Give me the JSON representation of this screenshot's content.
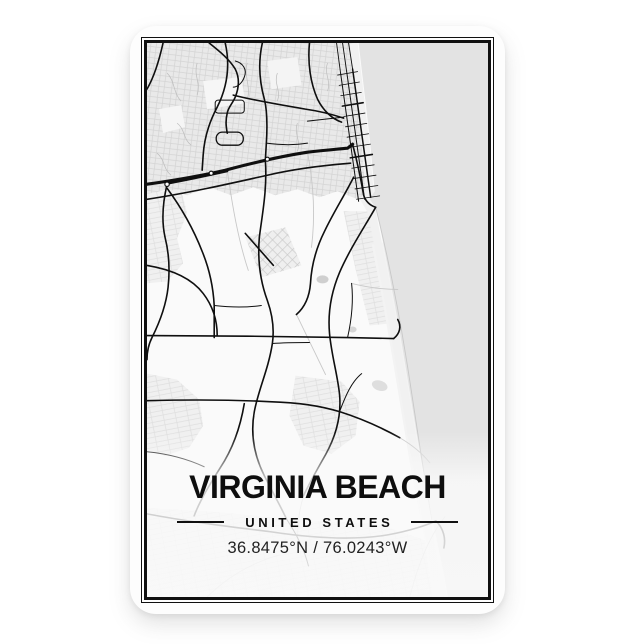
{
  "product": {
    "kind": "city map magnet",
    "background_color": "#ffffff",
    "magnet_face_color": "#fdfdfd",
    "frame_border_color": "#101010"
  },
  "map": {
    "city": "VIRGINIA BEACH",
    "country": "UNITED STATES",
    "coordinates": "36.8475°N / 76.0243°W",
    "style": "minimal black roads on light background",
    "colors": {
      "land": "#fafafa",
      "suburb_texture": "#e9e9e9",
      "ocean": "#e3e3e3",
      "beach": "#f1f1f1",
      "roads": "#0f0f0f",
      "minor_roads": "#c8c8c8"
    },
    "features": {
      "ocean_side": "right",
      "coastline": "diagonal top-right to bottom-right",
      "oceanfront_street_grid": true,
      "highway_band": "upper third, east-west"
    }
  }
}
